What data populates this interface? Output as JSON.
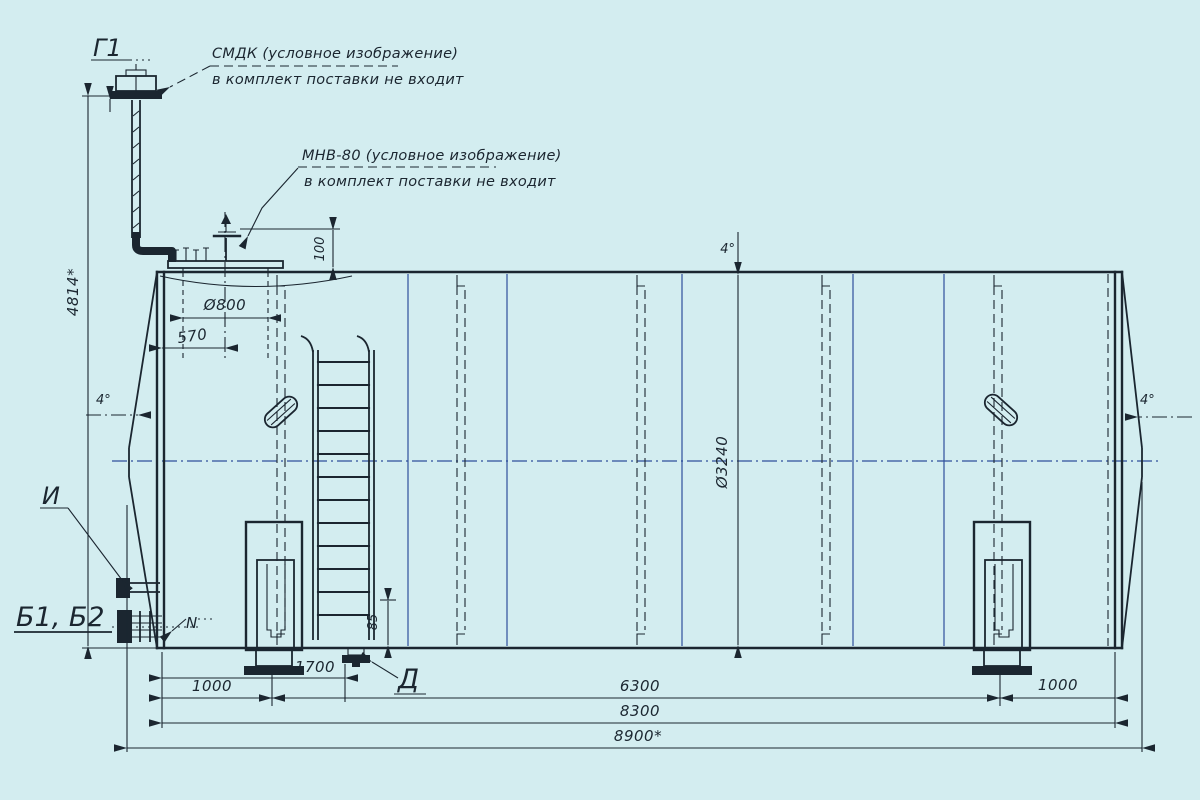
{
  "drawing": {
    "colors": {
      "paper": "#d3edf0",
      "ink": "#1b2630",
      "blue": "#2e4f9b"
    },
    "annotations": {
      "smdk": {
        "line1": "СМДК (условное изображение)",
        "line2": "в комплект поставки не входит"
      },
      "mnv": {
        "line1": "МНВ-80 (условное изображение)",
        "line2": "в комплект поставки не входит"
      }
    },
    "labels": {
      "g1": "Г1",
      "i": "И",
      "b1b2": "Б1, Б2",
      "n": "N",
      "d": "Д"
    },
    "dimensions": {
      "overall_height": "4814*",
      "manhole_diameter": "Ø800",
      "manhole_offset": "570",
      "hatch_height": "100",
      "tank_diameter": "Ø3240",
      "angle_left": "4°",
      "angle_top": "4°",
      "angle_right": "4°",
      "drain_height": "85",
      "end_to_support_left": "1000",
      "end_to_drain": "1700",
      "between_supports": "6300",
      "cylinder_length": "8300",
      "overall_length": "8900*",
      "support_to_end_right": "1000"
    }
  }
}
